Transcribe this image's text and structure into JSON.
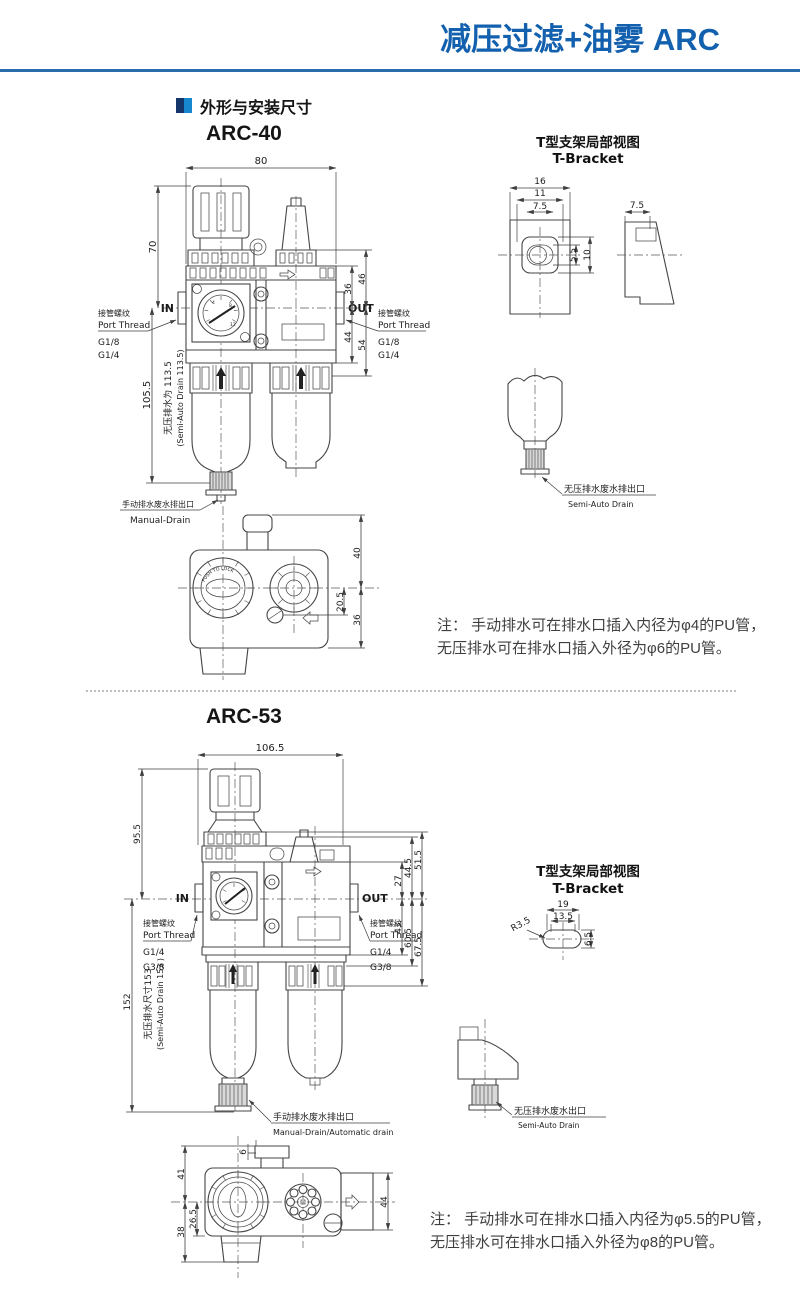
{
  "page": {
    "header_title": "减压过滤+油雾 ARC",
    "section_title": "外形与安装尺寸",
    "accent_color": "#1361ae"
  },
  "arc40": {
    "model": "ARC-40",
    "front": {
      "dim_width": "80",
      "dim_top_height": "70",
      "dim_body_height": "105.5",
      "drain_height_cn": "无压排水为 113.5",
      "drain_height_en": "(Semi-Auto Drain 113.5)",
      "in_label": "IN",
      "out_label": "OUT",
      "dim_36": "36",
      "dim_46": "46",
      "dim_44": "44",
      "dim_54": "54",
      "gauge": {
        "n1": "4",
        "n2": "8",
        "n3": "12"
      },
      "port_left": {
        "cn": "接管螺纹",
        "en": "Port Thread",
        "size1": "G1/8",
        "size2": "G1/4"
      },
      "port_right": {
        "cn": "接管螺纹",
        "en": "Port Thread",
        "size1": "G1/8",
        "size2": "G1/4"
      },
      "manual_drain_cn": "手动排水废水排出口",
      "manual_drain_en": "Manual-Drain"
    },
    "bottom_view": {
      "dim_40": "40",
      "dim_205": "20.5",
      "dim_36": "36",
      "knob_text": "PUSH TO LOCK"
    },
    "bracket": {
      "title_cn": "T型支架局部视图",
      "title_en": "T-Bracket",
      "dim_16": "16",
      "dim_11": "11",
      "dim_75a": "7.5",
      "dim_55": "5.5",
      "dim_10": "10",
      "dim_75b": "7.5"
    },
    "semi_drain": {
      "cn": "无压排水废水排出口",
      "en": "Semi-Auto Drain"
    },
    "note_line1": "注： 手动排水可在排水口插入内径为φ4的PU管，",
    "note_line2": "无压排水可在排水口插入外径为φ6的PU管。"
  },
  "arc53": {
    "model": "ARC-53",
    "front": {
      "dim_width": "106.5",
      "dim_top_height": "95.5",
      "dim_body_height": "152",
      "drain_height_cn": "无压排水尺寸153",
      "drain_height_en": "(Semi-Auto Drain 153 )",
      "in_label": "IN",
      "out_label": "OUT",
      "dim_27": "27",
      "dim_445": "44.5",
      "dim_515": "51.5",
      "dim_43": "43",
      "dim_605": "60.5",
      "dim_675": "67.5",
      "port_left": {
        "cn": "接管螺纹",
        "en": "Port Thread",
        "size1": "G1/4",
        "size2": "G3/8"
      },
      "port_right": {
        "cn": "接管螺纹",
        "en": "Port Thread",
        "size1": "G1/4",
        "size2": "G3/8"
      },
      "manual_drain_cn": "手动排水废水排出口",
      "manual_drain_en": "Manual-Drain/Automatic drain"
    },
    "bottom_view": {
      "dim_6": "6",
      "dim_41": "41",
      "dim_265": "26.5",
      "dim_38": "38",
      "dim_44": "44"
    },
    "bracket": {
      "title_cn": "T型支架局部视图",
      "title_en": "T-Bracket",
      "dim_19": "19",
      "dim_135": "13.5",
      "dim_r35": "R3.5",
      "dim_65": "6.5"
    },
    "semi_drain": {
      "cn": "无压排水废水出口",
      "en": "Semi-Auto Drain"
    },
    "note_line1": "注： 手动排水可在排水口插入内径为φ5.5的PU管，",
    "note_line2": "无压排水可在排水口插入外径为φ8的PU管。"
  }
}
